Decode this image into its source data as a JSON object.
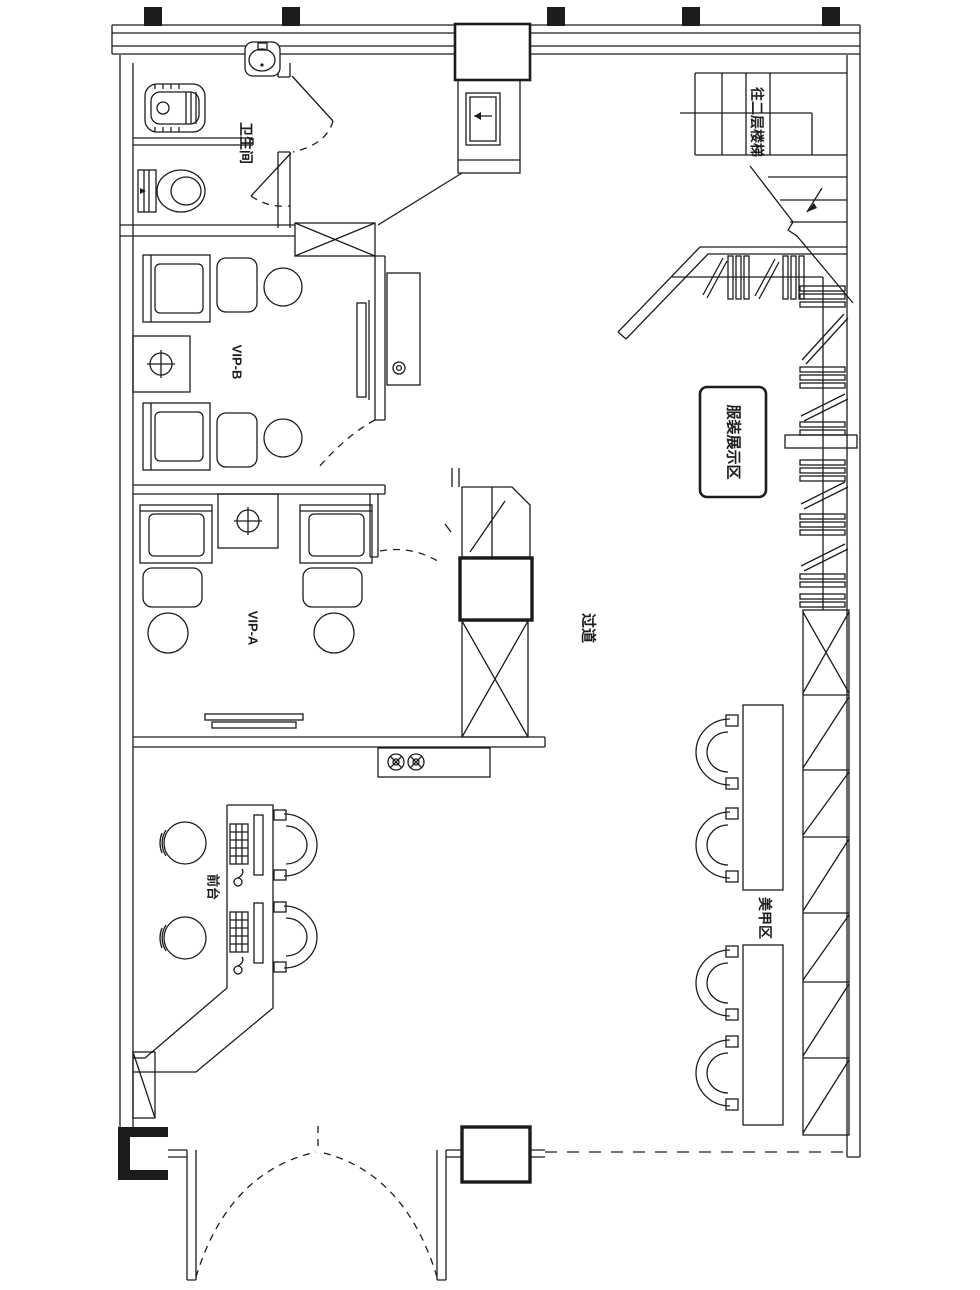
{
  "drawing": {
    "type": "floor-plan",
    "colors": {
      "ink": "#1c1c1c",
      "paper": "#ffffff"
    },
    "rooms": {
      "bathroom_label": "卫生间",
      "vip_b_label": "VIP-B",
      "vip_a_label": "VIP-A",
      "corridor_label": "过道",
      "display_area_label": "服装展示区",
      "stairs_label": "往二层楼梯",
      "front_desk_label": "前台",
      "nail_area_label": "美甲区"
    }
  }
}
